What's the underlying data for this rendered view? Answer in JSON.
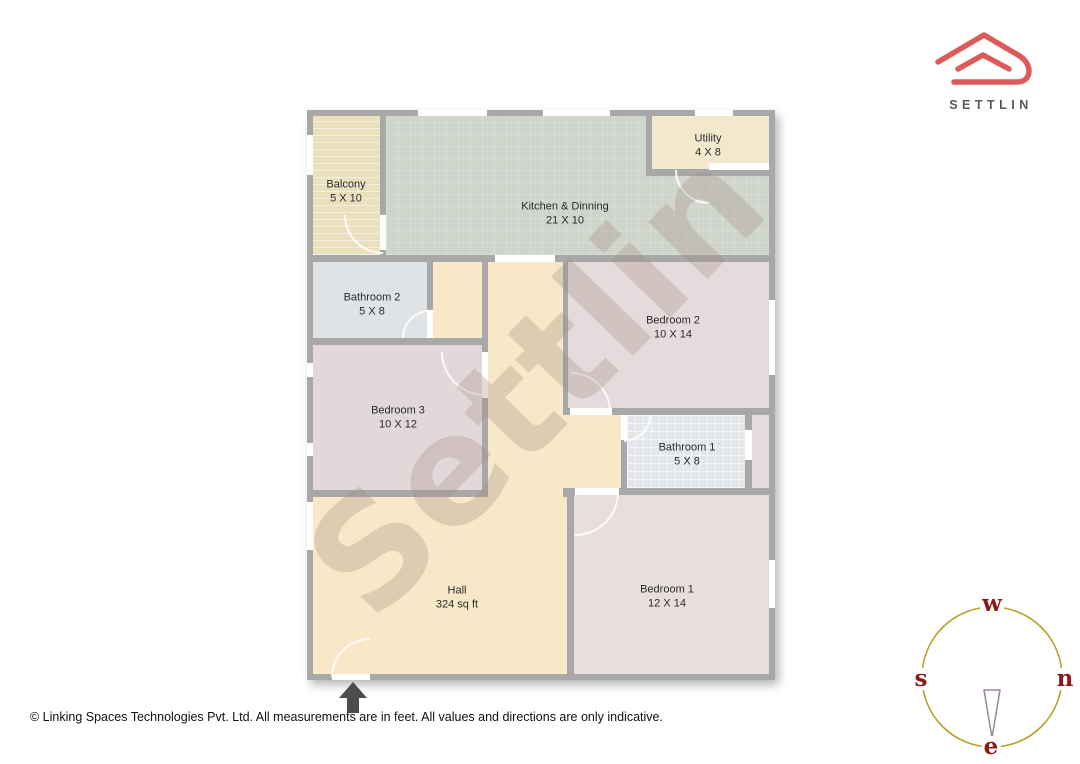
{
  "brand": {
    "logo_text": "SETTLIN",
    "logo_color": "#de5a5a",
    "logo_text_color": "#58595b"
  },
  "watermark": {
    "text": "Settlin"
  },
  "floorplan": {
    "wall_color": "#a8a8a8",
    "door_arc_color": "#ffffff",
    "rooms": [
      {
        "name": "Balcony",
        "dims": "5 X 10",
        "color": "#eae0bd"
      },
      {
        "name": "Kitchen & Dinning",
        "dims": "21 X 10",
        "color": "#d0d5cb"
      },
      {
        "name": "Utility",
        "dims": "4 X 8",
        "color": "#f2e9cc"
      },
      {
        "name": "Bathroom 2",
        "dims": "5 X 8",
        "color": "#e0e3e6"
      },
      {
        "name": "Bedroom 2",
        "dims": "10 X 14",
        "color": "#e5dbdc"
      },
      {
        "name": "Bedroom 3",
        "dims": "10 X 12",
        "color": "#e2d8da"
      },
      {
        "name": "Bathroom 1",
        "dims": "5 X 8",
        "color": "#e4e7e9"
      },
      {
        "name": "Hall",
        "dims": "324 sq ft",
        "color": "#f9e8c8"
      },
      {
        "name": "Bedroom 1",
        "dims": "12 X 14",
        "color": "#e9dede"
      }
    ]
  },
  "compass": {
    "top": "w",
    "left": "s",
    "right": "n",
    "bottom": "e",
    "ring_color": "#b5a22b",
    "letter_color": "#8b1b1b",
    "needle_color": "#9b87a0"
  },
  "footer": {
    "caption": "© Linking Spaces Technologies Pvt. Ltd. All measurements are in feet. All values and directions are only indicative."
  }
}
